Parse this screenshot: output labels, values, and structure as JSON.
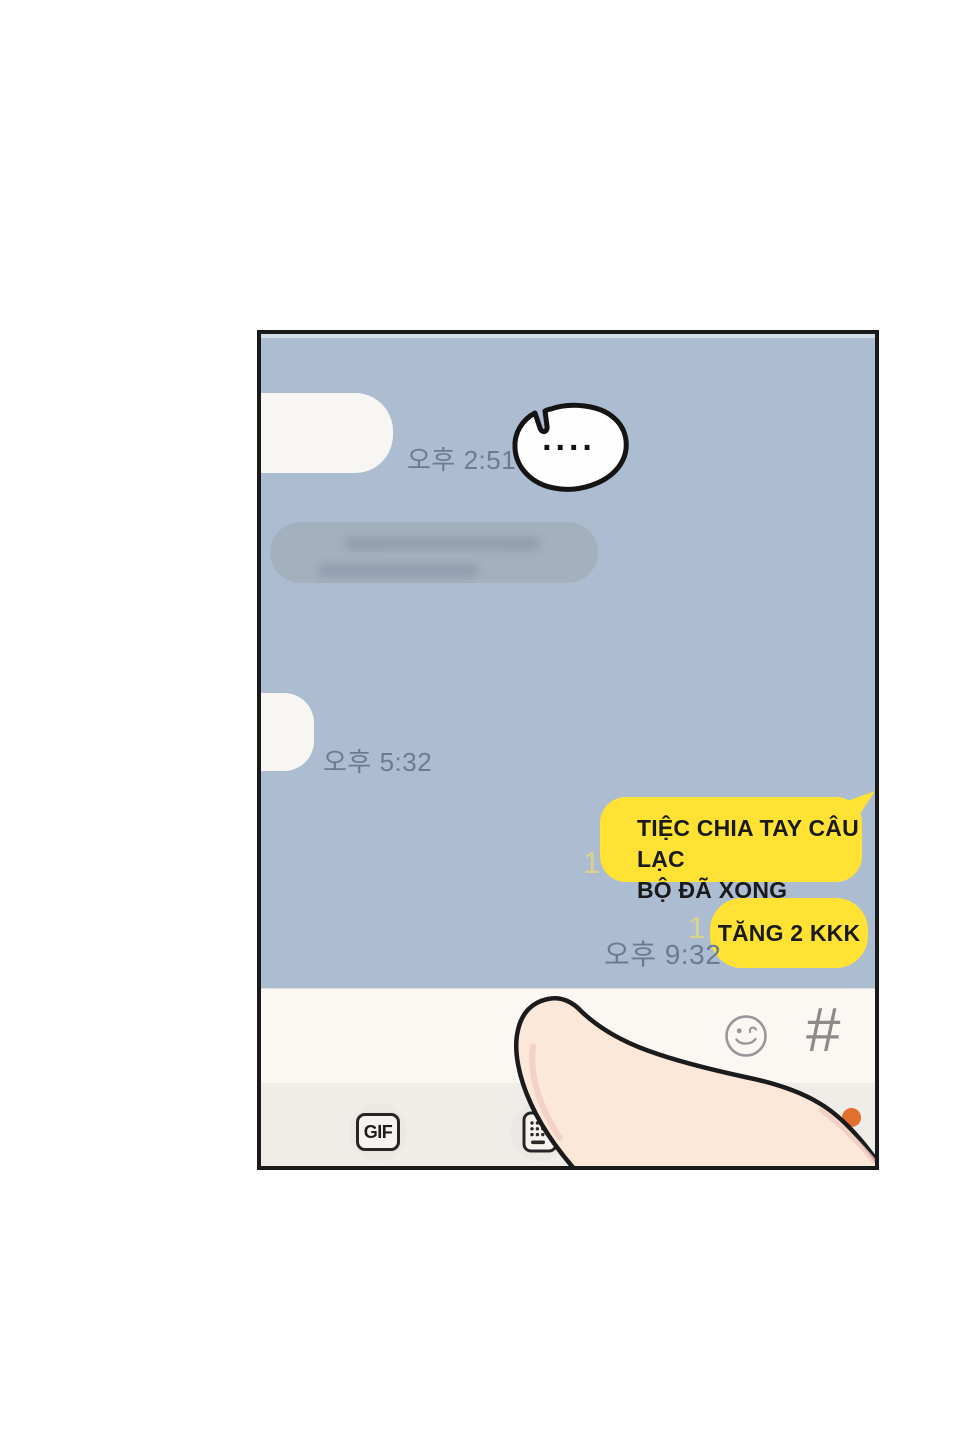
{
  "colors": {
    "page_bg": "#FFFFFF",
    "panel_border": "#1A1A1A",
    "chat_bg": "#ACBDD1",
    "incoming_bubble": "#F8F6F2",
    "muted_bubble": "#A3B0BD",
    "outgoing_bubble": "#FFE233",
    "unread_count": "#D9D489",
    "timestamp": "#6B7C92",
    "composer_bg": "#FBF7F2",
    "toolbar_bg": "#F0EDE9",
    "notification_dot": "#E0702D",
    "finger_skin": "#FBE8D9"
  },
  "chat": {
    "thought": {
      "text": "...."
    },
    "incoming": [
      {
        "time": "오후 2:51"
      },
      {
        "time": "오후 5:32"
      }
    ],
    "outgoing": [
      {
        "line1": "TIỆC CHIA TAY CÂU LẠC",
        "line2": "BỘ ĐÃ XONG",
        "unread": "1"
      },
      {
        "text": "TĂNG 2 KKK",
        "unread": "1",
        "time": "오후 9:32"
      }
    ]
  },
  "composer": {
    "emoji_icon": "winking-smiley-icon",
    "hash_label": "#",
    "gif_label": "GIF",
    "keyboard_icon": "keyboard-icon",
    "notification": "orange-dot"
  }
}
